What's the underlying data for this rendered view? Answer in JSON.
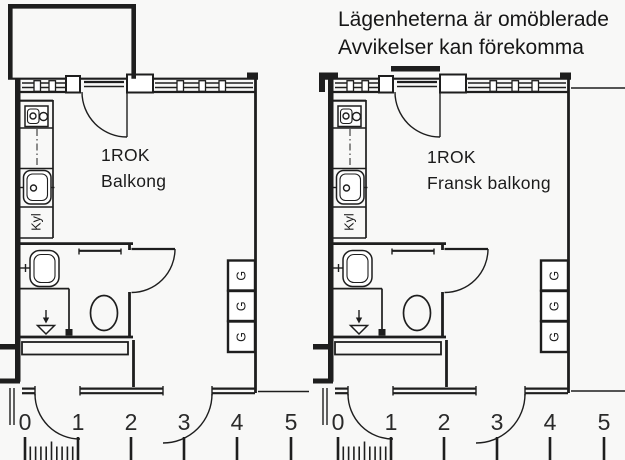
{
  "header": {
    "line1": "Lägenheterna är omöblerade",
    "line2": "Avvikelser kan förekomma"
  },
  "plans": [
    {
      "title": "1ROK",
      "subtitle": "Balkong",
      "fridge_label": "Kyl",
      "wardrobes": [
        "G",
        "G",
        "G"
      ]
    },
    {
      "title": "1ROK",
      "subtitle": "Fransk balkong",
      "fridge_label": "Kyl",
      "wardrobes": [
        "G",
        "G",
        "G"
      ]
    }
  ],
  "scale_rulers": [
    {
      "labels": [
        "0",
        "1",
        "2",
        "3",
        "4",
        "5"
      ]
    },
    {
      "labels": [
        "0",
        "1",
        "2",
        "3",
        "4",
        "5"
      ]
    }
  ],
  "symbols": {
    "stove": "stove-icon",
    "sink": "sink-icon",
    "washbasin": "washbasin-icon",
    "toilet": "toilet-icon",
    "floor_drain": "floor-drain-icon",
    "wardrobe": "wardrobe-box",
    "french_balcony": "french-balcony-bar",
    "balcony": "balcony-outline",
    "door_swing": "door-swing-arc",
    "window": "window-band"
  },
  "colors": {
    "line": "#1e1e1e",
    "background": "#f8f8f7",
    "room_fill": "#ffffff"
  }
}
